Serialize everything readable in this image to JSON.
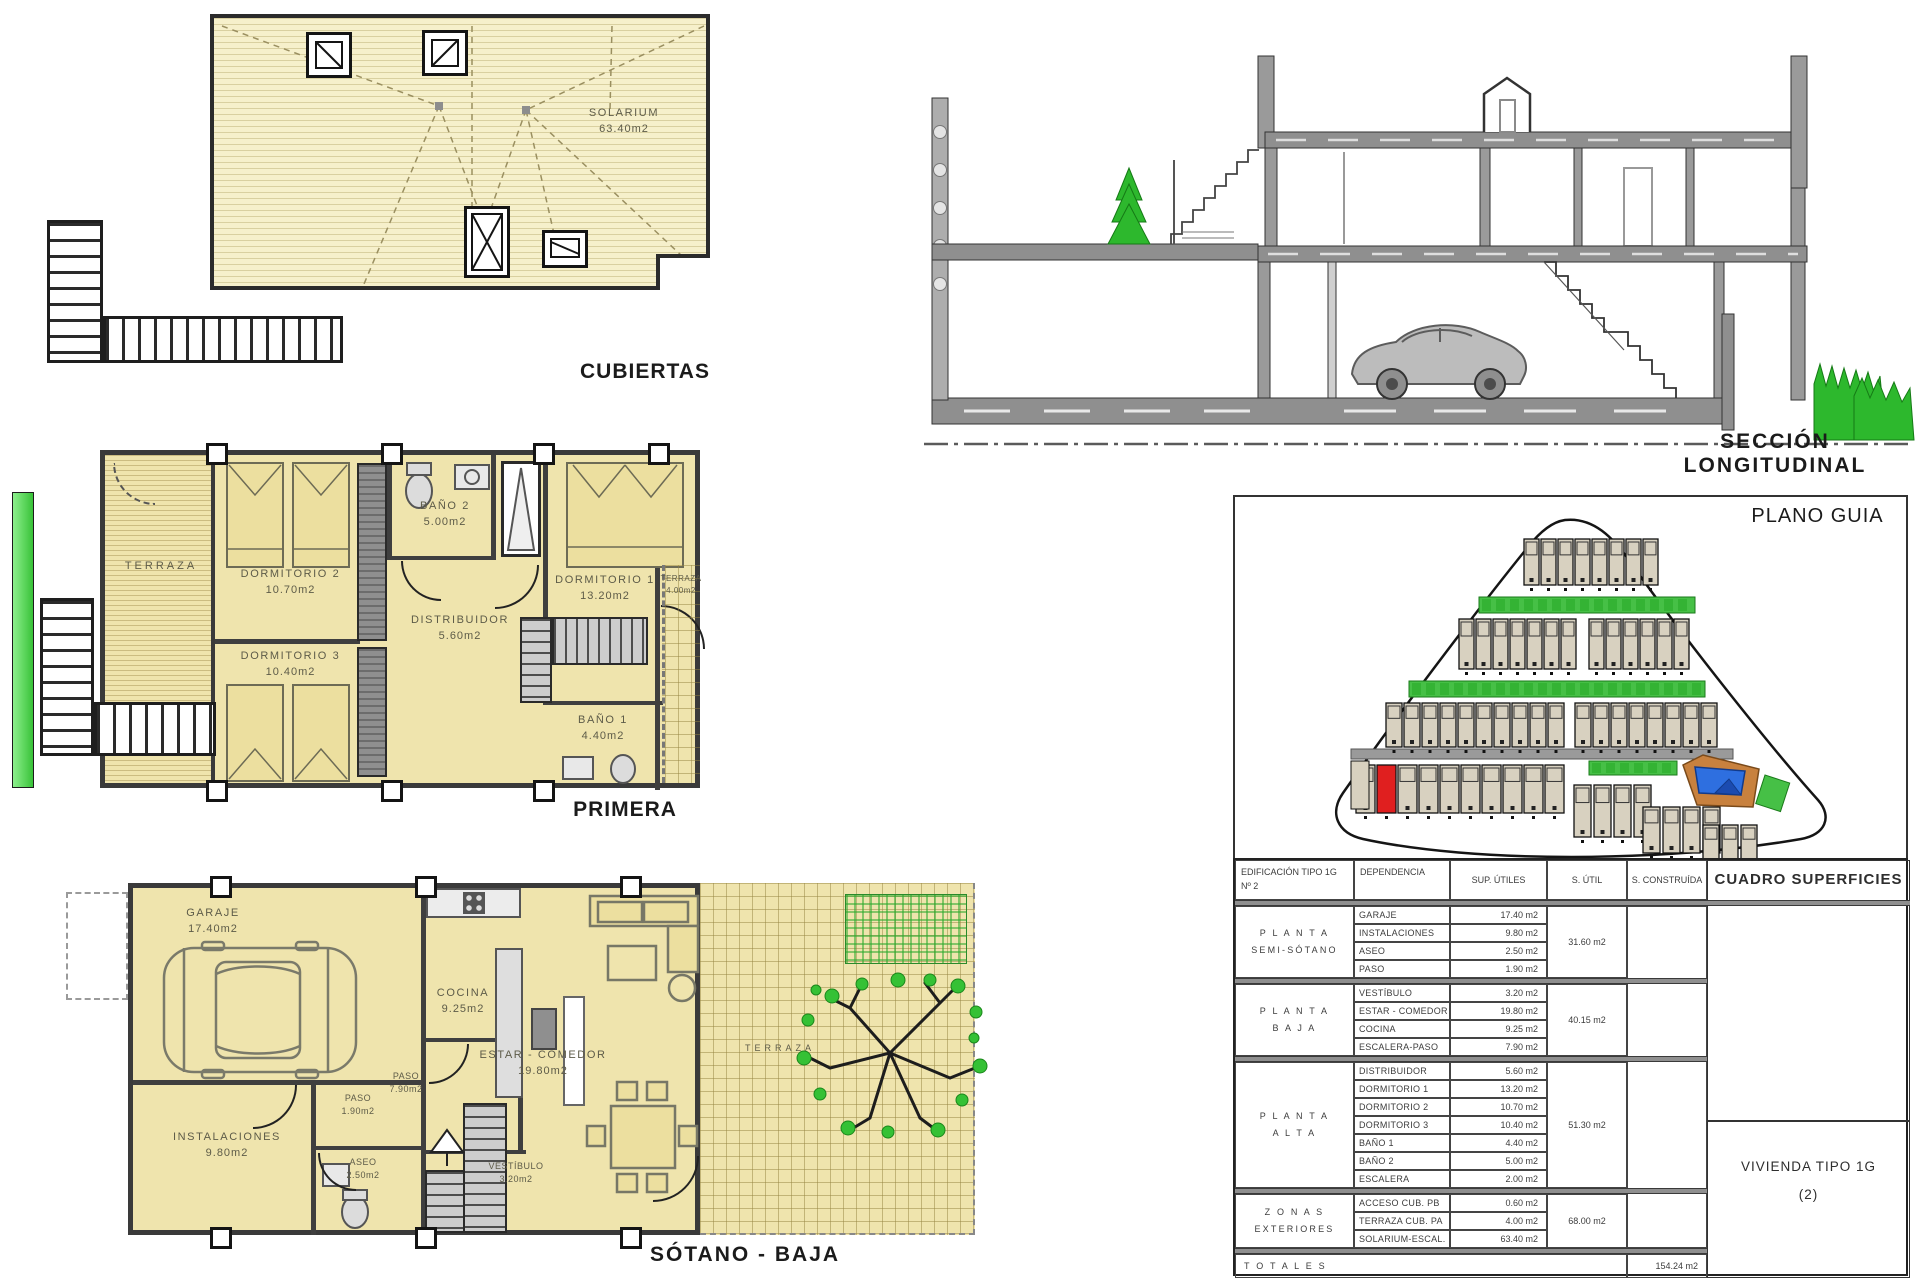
{
  "titles": {
    "cubiertas": "CUBIERTAS",
    "seccion": "SECCIÓN  LONGITUDINAL",
    "primera": "PRIMERA",
    "sotano": "SÓTANO - BAJA",
    "plano_guia": "PLANO GUIA"
  },
  "roof": {
    "solarium_name": "SOLARIUM",
    "solarium_area": "63.40m2"
  },
  "primera": {
    "terraza_left": {
      "name": "TERRAZA"
    },
    "dorm2": {
      "name": "DORMITORIO 2",
      "area": "10.70m2"
    },
    "dorm3": {
      "name": "DORMITORIO 3",
      "area": "10.40m2"
    },
    "bano2": {
      "name": "BAÑO 2",
      "area": "5.00m2"
    },
    "distribuidor": {
      "name": "DISTRIBUIDOR",
      "area": "5.60m2"
    },
    "dorm1": {
      "name": "DORMITORIO 1",
      "area": "13.20m2"
    },
    "terraza_right": {
      "name": "TERRAZA",
      "area": "4.00m2"
    },
    "bano1": {
      "name": "BAÑO 1",
      "area": "4.40m2"
    }
  },
  "sotano": {
    "garaje": {
      "name": "GARAJE",
      "area": "17.40m2"
    },
    "instalaciones": {
      "name": "INSTALACIONES",
      "area": "9.80m2"
    },
    "paso1": {
      "name": "PASO",
      "area": "1.90m2"
    },
    "aseo": {
      "name": "ASEO",
      "area": "2.50m2"
    },
    "paso2": {
      "name": "PASO",
      "area": "7.90m2"
    },
    "cocina": {
      "name": "COCINA",
      "area": "9.25m2"
    },
    "estar": {
      "name": "ESTAR - COMEDOR",
      "area": "19.80m2"
    },
    "vestibulo": {
      "name": "VESTÍBULO",
      "area": "3.20m2"
    },
    "terraza": {
      "name": "TERRAZA"
    }
  },
  "table": {
    "col_headers": {
      "edificacion_line1": "EDIFICACIÓN TIPO 1G",
      "edificacion_line2": "Nº 2",
      "dependencia": "DEPENDENCIA",
      "sup_utiles": "SUP. ÚTILES",
      "s_util": "S. ÚTIL",
      "s_construida": "S. CONSTRUÍDA",
      "cuadro": "CUADRO SUPERFICIES"
    },
    "sections": [
      {
        "floor": "P L A N T A\nSEMI-SÓTANO",
        "rows": [
          [
            "GARAJE",
            "17.40 m2"
          ],
          [
            "INSTALACIONES",
            "9.80 m2"
          ],
          [
            "ASEO",
            "2.50 m2"
          ],
          [
            "PASO",
            "1.90 m2"
          ]
        ],
        "s_util": "31.60 m2"
      },
      {
        "floor": "P L A N T A\nB A J A",
        "rows": [
          [
            "VESTÍBULO",
            "3.20 m2"
          ],
          [
            "ESTAR - COMEDOR",
            "19.80 m2"
          ],
          [
            "COCINA",
            "9.25 m2"
          ],
          [
            "ESCALERA-PASO",
            "7.90 m2"
          ]
        ],
        "s_util": "40.15 m2"
      },
      {
        "floor": "P L A N T A\nA L T A",
        "rows": [
          [
            "DISTRIBUIDOR",
            "5.60 m2"
          ],
          [
            "DORMITORIO 1",
            "13.20 m2"
          ],
          [
            "DORMITORIO 2",
            "10.70 m2"
          ],
          [
            "DORMITORIO 3",
            "10.40 m2"
          ],
          [
            "BAÑO 1",
            "4.40 m2"
          ],
          [
            "BAÑO 2",
            "5.00 m2"
          ],
          [
            "ESCALERA",
            "2.00 m2"
          ]
        ],
        "s_util": "51.30 m2"
      },
      {
        "floor": "Z O N A S\nEXTERIORES",
        "rows": [
          [
            "ACCESO CUB. PB",
            "0.60 m2"
          ],
          [
            "TERRAZA CUB. PA",
            "4.00 m2"
          ],
          [
            "SOLARIUM-ESCAL.",
            "63.40 m2"
          ]
        ],
        "s_util": "68.00 m2"
      }
    ],
    "totales_label": "T O T A L E S",
    "total_construida": "154.24 m2",
    "vivienda_line1": "VIVIENDA TIPO 1G",
    "vivienda_line2": "(2)"
  },
  "site_plan": {
    "colors": {
      "house": "#d8d1c0",
      "outline": "#111111",
      "green": "#46c046",
      "dark_green": "#1ea41e",
      "red_unit": "#e01f1f",
      "pool_blue": "#2e6fe0",
      "deck_tan": "#c8813e",
      "road": "#9a9a9a"
    },
    "house_rows": [
      {
        "x": 291,
        "y": 44,
        "count": 8,
        "w": 15,
        "h": 46,
        "gap": 2
      },
      {
        "x": 226,
        "y": 124,
        "count": 7,
        "w": 15,
        "h": 50,
        "gap": 2
      },
      {
        "x": 356,
        "y": 124,
        "count": 6,
        "w": 15,
        "h": 50,
        "gap": 2
      },
      {
        "x": 153,
        "y": 208,
        "count": 10,
        "w": 16,
        "h": 44,
        "gap": 2
      },
      {
        "x": 342,
        "y": 208,
        "count": 8,
        "w": 16,
        "h": 44,
        "gap": 2
      },
      {
        "x": 123,
        "y": 270,
        "count": 10,
        "w": 19,
        "h": 48,
        "gap": 2,
        "red_index": 1
      },
      {
        "x": 341,
        "y": 290,
        "count": 4,
        "w": 17,
        "h": 52,
        "gap": 3
      },
      {
        "x": 410,
        "y": 312,
        "count": 4,
        "w": 17,
        "h": 46,
        "gap": 3
      },
      {
        "x": 470,
        "y": 330,
        "count": 3,
        "w": 16,
        "h": 40,
        "gap": 3
      }
    ],
    "green_strips": [
      {
        "x": 246,
        "y": 102,
        "w": 216,
        "h": 16
      },
      {
        "x": 176,
        "y": 186,
        "w": 296,
        "h": 16
      },
      {
        "x": 356,
        "y": 266,
        "w": 88,
        "h": 14
      }
    ],
    "road": {
      "x": 118,
      "y": 254,
      "w": 382,
      "h": 10
    },
    "pool": {
      "x": 450,
      "y": 260,
      "w": 76,
      "h": 52
    }
  }
}
